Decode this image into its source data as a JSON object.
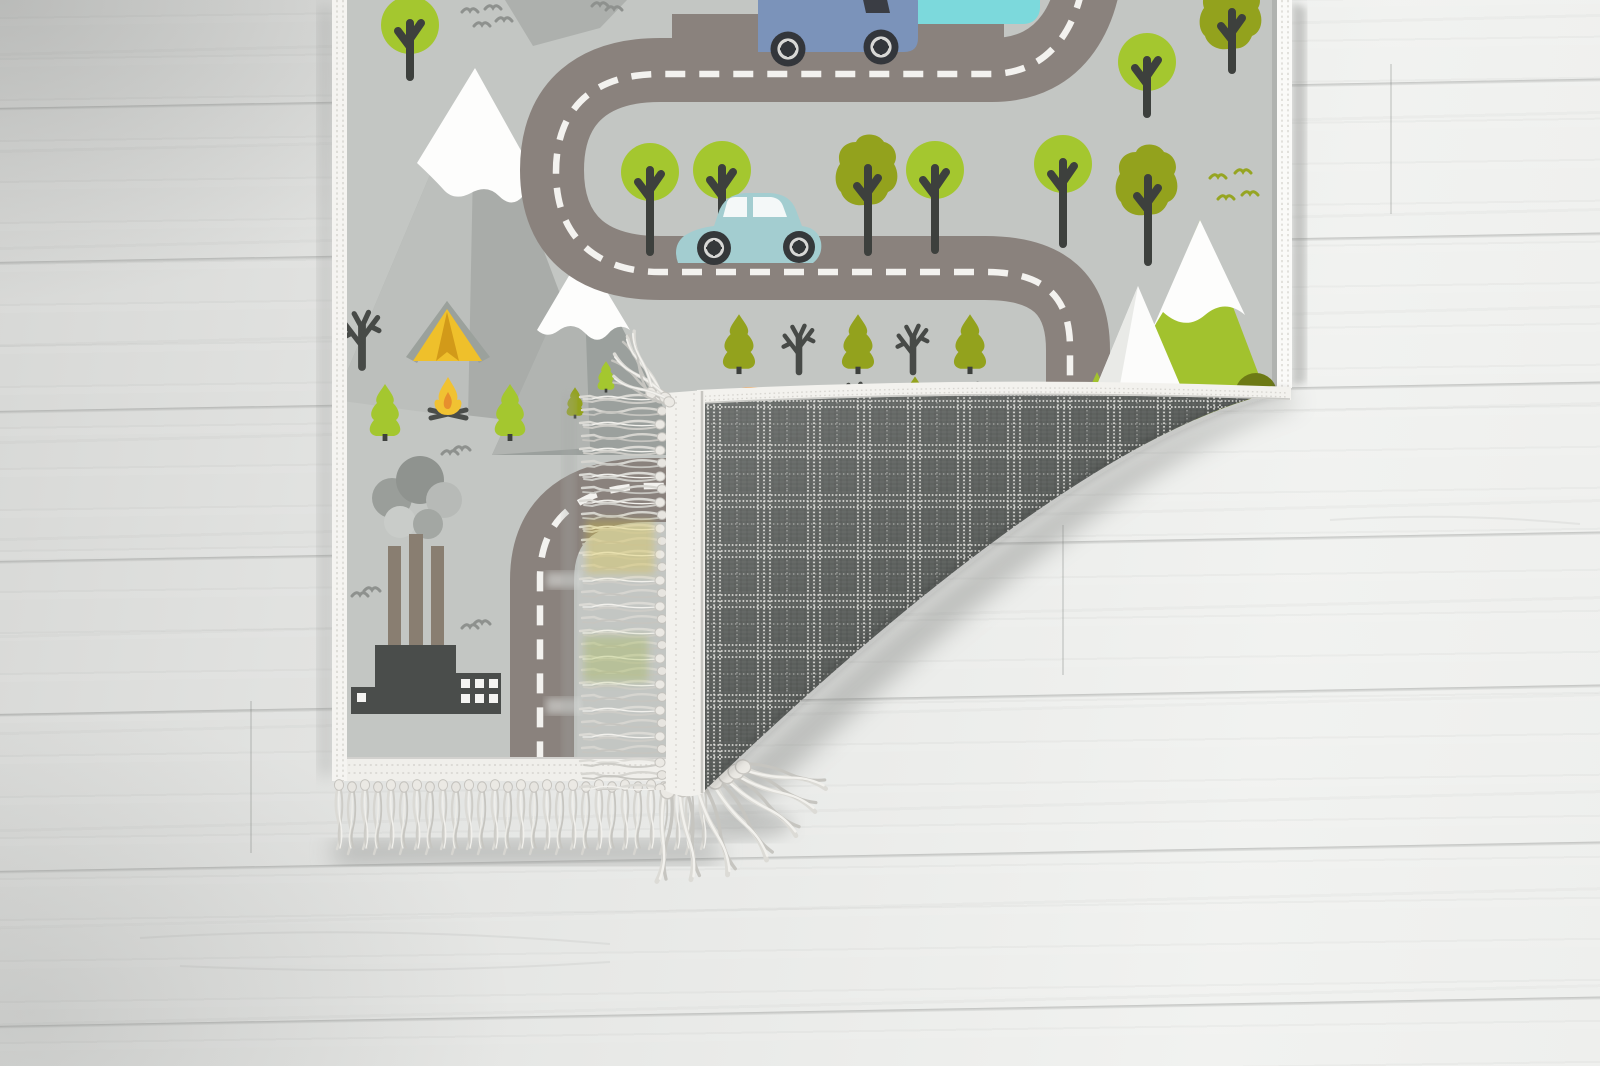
{
  "title": "Product photo of a children's road play rug folded at one corner on a whitewashed wood floor",
  "scene": {
    "floor": {
      "material": "whitewashed wood planks",
      "plank_seams": 7
    },
    "rug": {
      "theme": "kids road play mat",
      "state": "bottom-right corner folded over, showing plaid woven backing and tasseled fringe",
      "front_features": [
        "winding road with white dashed centerline",
        "snow-capped gray mountains",
        "green mountain with snow band",
        "round and olive trees",
        "pine trees",
        "bare trees",
        "camping tent",
        "campfire",
        "factory with three chimneys and smoke",
        "flying birds"
      ],
      "vehicles": [
        "blue van on top road",
        "teal camper behind van",
        "light blue car on middle road",
        "orange vehicle peeking above fold"
      ],
      "backing": "dark gray tartan plaid with white pinstripes",
      "fringe": "light gray knotted tassels on short edges"
    }
  },
  "colors": {
    "rug_background": "#c3c6c3",
    "road_surface": "#8a827d",
    "road_marking": "#f3f2ef",
    "tree_green": "#a4c72f",
    "tree_olive": "#93a21d",
    "dark_olive_bush": "#6d7a15",
    "mountain_gray": "#a9aca9",
    "mountain_gray_front": "#9ba09d",
    "green_mountain": "#a2c22e",
    "snow": "#fdfdfc",
    "tent": "#efc02b",
    "campfire_flame": "#f1c232",
    "campfire_core": "#e78f2d",
    "factory": "#4a4d4b",
    "chimney": "#897e71",
    "van": "#7b93ba",
    "camper": "#7cd9dc",
    "car": "#a3cdd0",
    "hidden_vehicle": "#e8923c",
    "plaid_base": "#5a5e5b",
    "plaid_stripes": "#e8e7e3",
    "fringe": "#dbdad5",
    "selvage": "#f3f2ee"
  }
}
